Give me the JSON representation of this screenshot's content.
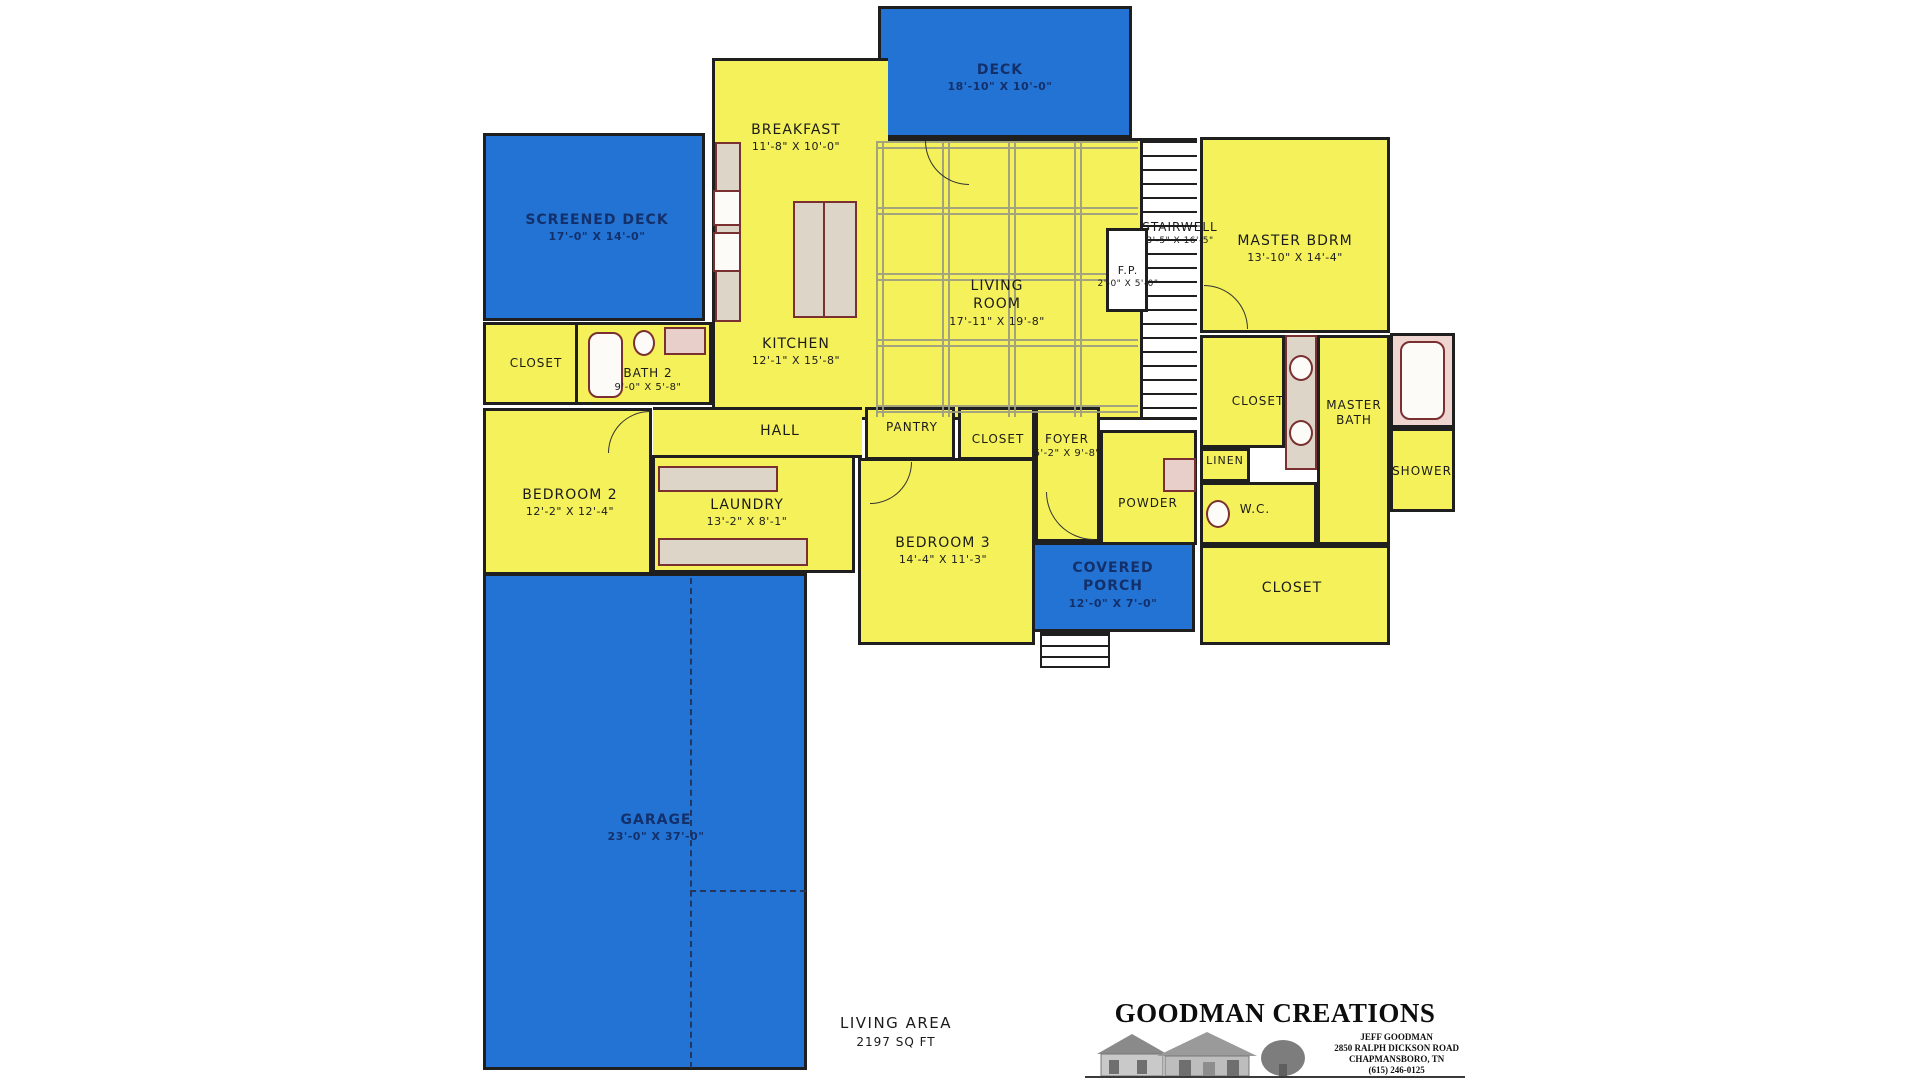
{
  "colors": {
    "room_fill": "#F5F15A",
    "outdoor_fill": "#2273D3",
    "wall": "#1f1f1f",
    "ceiling_grid": "#9b9b82",
    "fixture_fill": "#ded5c9",
    "fixture_outline": "#7a3030",
    "outdoor_text": "#14306b",
    "indoor_text": "#1b1b1b"
  },
  "rooms": [
    {
      "name": "DECK",
      "dims": "18'-10\" X 10'-0\""
    },
    {
      "name": "SCREENED DECK",
      "dims": "17'-0\" X 14'-0\""
    },
    {
      "name": "BREAKFAST",
      "dims": "11'-8\" X 10'-0\""
    },
    {
      "name": "LIVING ROOM",
      "dims": "17'-11\" X 19'-8\""
    },
    {
      "name": "KITCHEN",
      "dims": "12'-1\" X 15'-8\""
    },
    {
      "name": "STAIRWELL",
      "dims": "3'-5\" X 16'-5\""
    },
    {
      "name": "F.P.",
      "dims": "2'-0\" X 5'-0\""
    },
    {
      "name": "MASTER BDRM",
      "dims": "13'-10\" X 14'-4\""
    },
    {
      "name": "CLOSET",
      "dims": ""
    },
    {
      "name": "BATH 2",
      "dims": "9'-0\" X 5'-8\""
    },
    {
      "name": "HALL",
      "dims": ""
    },
    {
      "name": "PANTRY",
      "dims": ""
    },
    {
      "name": "CLOSET",
      "dims": ""
    },
    {
      "name": "FOYER",
      "dims": "6'-2\" X 9'-8\""
    },
    {
      "name": "POWDER",
      "dims": ""
    },
    {
      "name": "LINEN",
      "dims": ""
    },
    {
      "name": "CLOSET",
      "dims": ""
    },
    {
      "name": "MASTER BATH",
      "dims": ""
    },
    {
      "name": "SHOWER",
      "dims": ""
    },
    {
      "name": "W.C.",
      "dims": ""
    },
    {
      "name": "BEDROOM 2",
      "dims": "12'-2\" X 12'-4\""
    },
    {
      "name": "LAUNDRY",
      "dims": "13'-2\" X 8'-1\""
    },
    {
      "name": "BEDROOM 3",
      "dims": "14'-4\" X 11'-3\""
    },
    {
      "name": "COVERED PORCH",
      "dims": "12'-0\" X 7'-0\""
    },
    {
      "name": "CLOSET",
      "dims": ""
    },
    {
      "name": "GARAGE",
      "dims": "23'-0\" X 37'-0\""
    }
  ],
  "title_block": {
    "living_area_label": "LIVING AREA",
    "living_area_value": "2197 SQ FT",
    "logo_title": "GOODMAN CREATIONS",
    "logo_line1": "JEFF GOODMAN",
    "logo_line2": "2850 RALPH DICKSON ROAD",
    "logo_line3": "CHAPMANSBORO, TN",
    "logo_line4": "(615) 246-0125"
  }
}
